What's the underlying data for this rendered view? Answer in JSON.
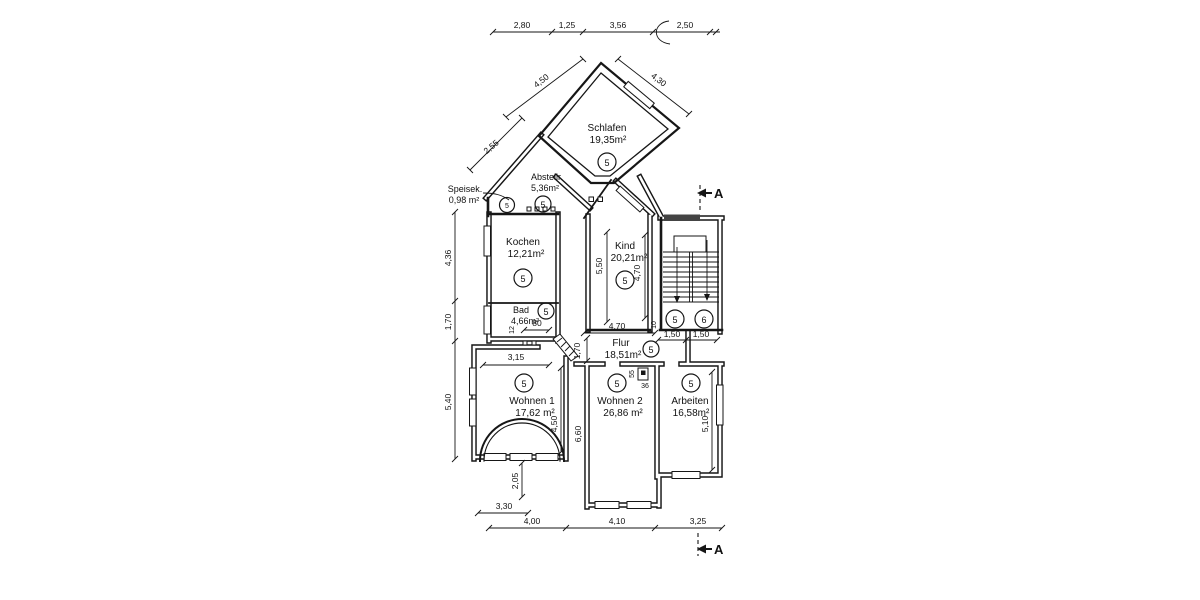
{
  "rooms": [
    {
      "name": "Schlafen",
      "area": "19,35m²",
      "zone": "5"
    },
    {
      "name": "Abstellr.",
      "area": "5,36m²",
      "zone": "5"
    },
    {
      "name": "Speisek.",
      "area": "0,98 m²",
      "zone": "5"
    },
    {
      "name": "Kochen",
      "area": "12,21m²",
      "zone": "5"
    },
    {
      "name": "Bad",
      "area": "4,66m²",
      "zone": "5"
    },
    {
      "name": "Kind",
      "area": "20,21m²",
      "zone": "5"
    },
    {
      "name": "Flur",
      "area": "18,51m²",
      "zone": "5"
    },
    {
      "name": "Wohnen 1",
      "area": "17,62 m²",
      "zone": "5"
    },
    {
      "name": "Wohnen 2",
      "area": "26,86 m²",
      "zone": "5"
    },
    {
      "name": "Arbeiten",
      "area": "16,58m²",
      "zone": "5"
    }
  ],
  "stair": {
    "left_zone": "5",
    "right_zone": "6"
  },
  "dims": {
    "top": [
      "2,80",
      "1,25",
      "3,56",
      "2,50"
    ],
    "left": [
      "4,36",
      "1,70",
      "5,40"
    ],
    "bottom": [
      "4,00",
      "4,10",
      "3,25"
    ],
    "diag_speisek": "2,55",
    "diag_left": "4,50",
    "diag_right": "4,30",
    "kind_height": "5,50",
    "kind_inner_height": "4,70",
    "kind_width": "4,70",
    "kind_small": "10",
    "stair_left": "1,50",
    "stair_right": "1,50",
    "flur_height": "1,70",
    "wohnen1_width": "3,15",
    "wohnen1_height": "4,50",
    "bad_door_width": "80",
    "bad_door_off": "12",
    "wohnen2_small_v": "55",
    "wohnen2_small_h": "36",
    "wohnen2_height": "6,60",
    "arbeiten_height": "5,10",
    "bay_depth": "2,05",
    "bay_width": "3,30"
  },
  "section_label": "A"
}
